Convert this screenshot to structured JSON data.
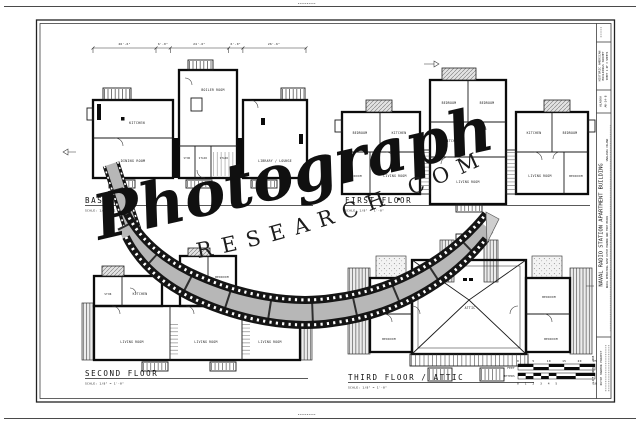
{
  "watermark": {
    "script_text": "Photograph",
    "arc_text": "RESEARCH.COM"
  },
  "title_block": {
    "survey_line1": "HISTORIC AMERICAN",
    "survey_line2": "BUILDINGS SURVEY",
    "survey_line3": "SHEET 1 OF 3 SHEETS",
    "state": "ALASKA",
    "survey_no": "AK-24-B",
    "main_title": "NAVAL RADIO STATION APARTMENT BUILDING",
    "subtitle": "NAVAL OPERATING BASE  DUTCH HARBOR AND FORT MEARS",
    "location": "UNALASKA ISLAND",
    "project_box": "DUTCH HARBOR PROJECT",
    "delineator": "CLIFF BOOKMAN, 1988"
  },
  "plans": {
    "basement": {
      "title": "BASEMENT",
      "scale_note": "SCALE: 1/8\" = 1'-0\"",
      "dimensions": [
        "26'-6\"",
        "6'-0\"",
        "24'-6\"",
        "6'-0\"",
        "26'-6\""
      ],
      "rooms": [
        "KITCHEN",
        "DINING ROOM",
        "BOILER ROOM",
        "STOR",
        "STAIR",
        "STAIR",
        "LIBRARY / LOUNGE"
      ]
    },
    "first_floor": {
      "title": "FIRST FLOOR",
      "scale_note": "SCALE: 1/8\" = 1'-0\"",
      "rooms": [
        "BEDROOM",
        "KITCHEN",
        "BEDROOM",
        "LIVING ROOM",
        "BEDROOM",
        "BEDROOM",
        "KITCHEN",
        "LIVING ROOM",
        "KITCHEN",
        "BEDROOM",
        "LIVING ROOM",
        "BEDROOM"
      ]
    },
    "second_floor": {
      "title": "SECOND FLOOR",
      "scale_note": "SCALE: 1/8\" = 1'-0\"",
      "rooms": [
        "STOR",
        "KITCHEN",
        "BEDROOM",
        "BEDROOM",
        "LIVING ROOM",
        "LIVING ROOM",
        "LIVING ROOM"
      ]
    },
    "third_floor": {
      "title": "THIRD FLOOR / ATTIC",
      "scale_note": "SCALE: 1/8\" = 1'-0\"",
      "rooms": [
        "BEDROOM",
        "BEDROOM",
        "ATTIC",
        "BEDROOM",
        "BEDROOM"
      ]
    }
  },
  "scale_bar": {
    "feet_label": "FEET",
    "feet_ticks": [
      "0",
      "5",
      "10",
      "15",
      "20",
      "25"
    ],
    "meters_label": "METERS",
    "meters_ticks": [
      "0",
      "1",
      "2",
      "3",
      "4",
      "5",
      "10"
    ]
  },
  "colors": {
    "paper": "#ffffff",
    "ink": "#111111",
    "film_gray": "#b7b7b7"
  }
}
